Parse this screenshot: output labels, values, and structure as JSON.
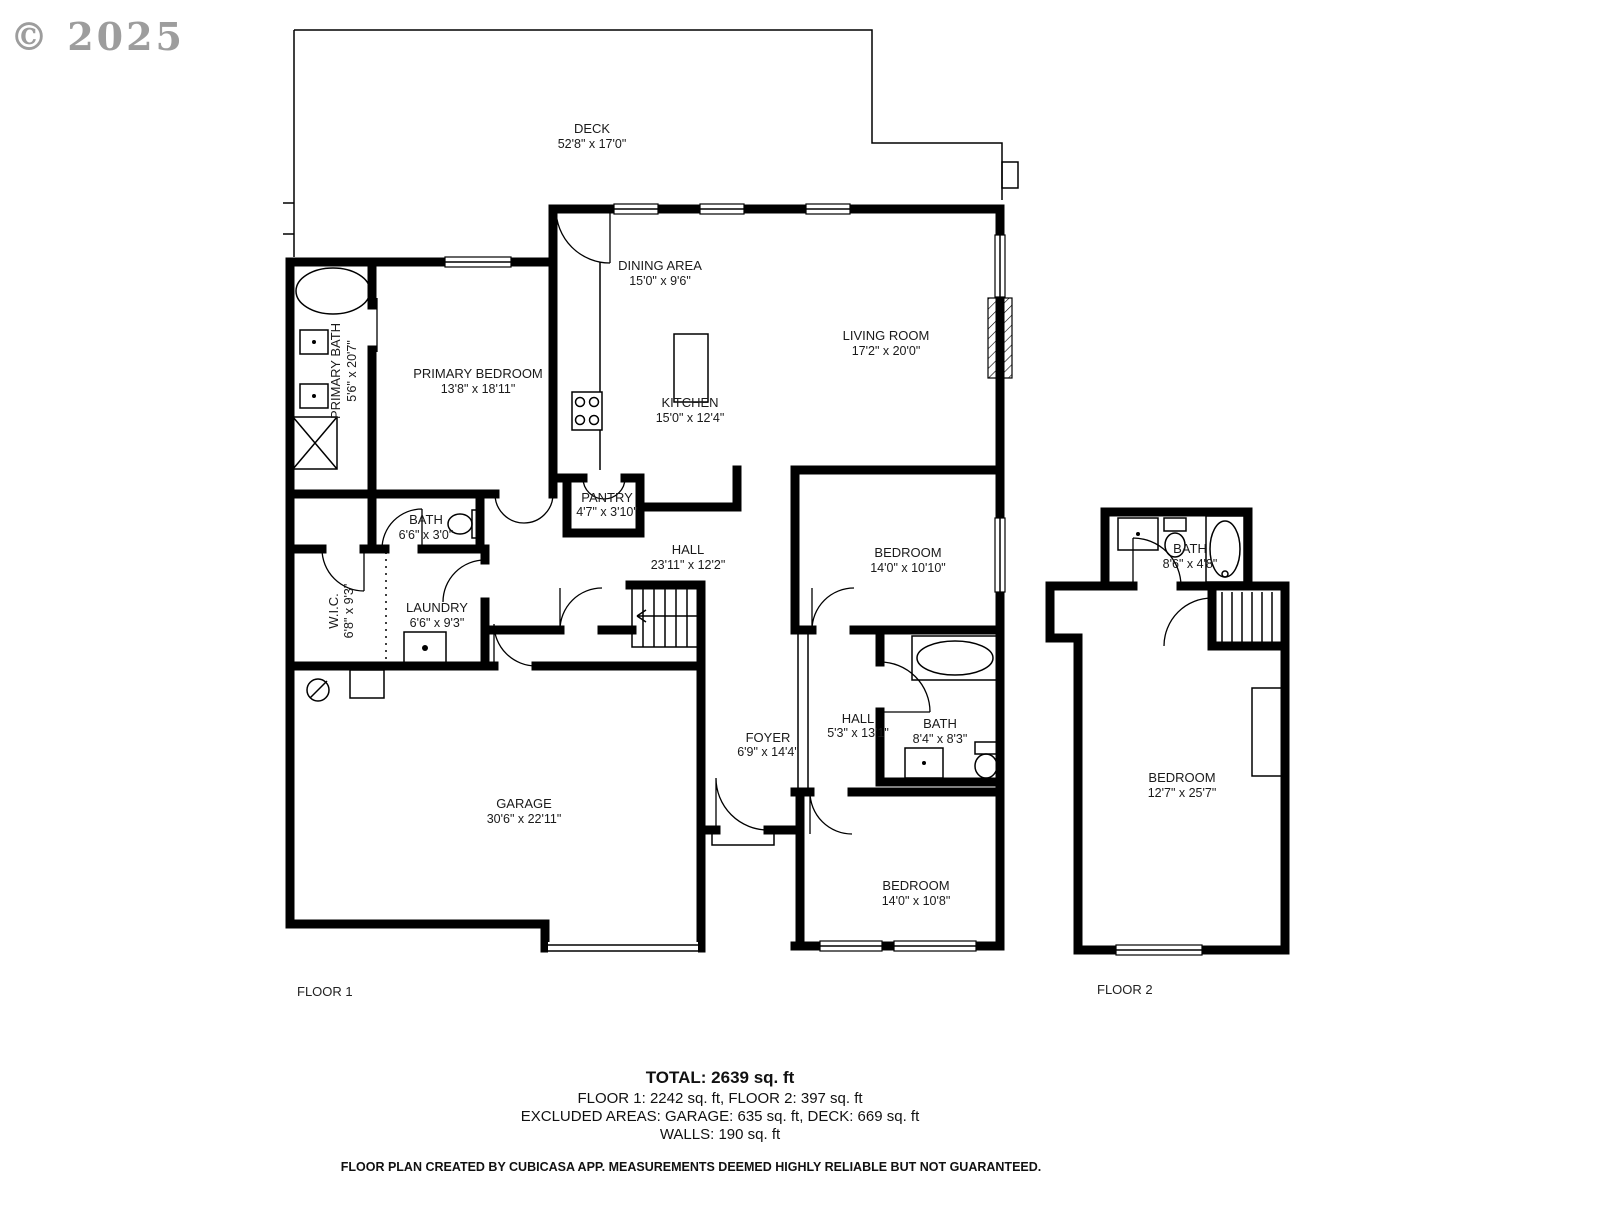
{
  "watermark": "© 2025",
  "floor1": {
    "label": "FLOOR 1",
    "rooms": {
      "deck": {
        "name": "DECK",
        "dims": "52'8\" x 17'0\""
      },
      "dining": {
        "name": "DINING AREA",
        "dims": "15'0\" x 9'6\""
      },
      "living": {
        "name": "LIVING ROOM",
        "dims": "17'2\" x 20'0\""
      },
      "primary_bedroom": {
        "name": "PRIMARY BEDROOM",
        "dims": "13'8\" x 18'11\""
      },
      "primary_bath": {
        "name": "PRIMARY BATH",
        "dims": "5'6\" x 20'7\""
      },
      "kitchen": {
        "name": "KITCHEN",
        "dims": "15'0\" x 12'4\""
      },
      "pantry": {
        "name": "PANTRY",
        "dims": "4'7\" x 3'10\""
      },
      "hall": {
        "name": "HALL",
        "dims": "23'11\" x 12'2\""
      },
      "bath": {
        "name": "BATH",
        "dims": "6'6\" x 3'0\""
      },
      "wic": {
        "name": "W.I.C.",
        "dims": "6'8\" x 9'3\""
      },
      "laundry": {
        "name": "LAUNDRY",
        "dims": "6'6\" x 9'3\""
      },
      "bedroom1": {
        "name": "BEDROOM",
        "dims": "14'0\" x 10'10\""
      },
      "hall2": {
        "name": "HALL",
        "dims": "5'3\" x 13'1\""
      },
      "bath2": {
        "name": "BATH",
        "dims": "8'4\" x 8'3\""
      },
      "foyer": {
        "name": "FOYER",
        "dims": "6'9\" x 14'4\""
      },
      "garage": {
        "name": "GARAGE",
        "dims": "30'6\" x 22'11\""
      },
      "bedroom2": {
        "name": "BEDROOM",
        "dims": "14'0\" x 10'8\""
      }
    }
  },
  "floor2": {
    "label": "FLOOR 2",
    "rooms": {
      "bath": {
        "name": "BATH",
        "dims": "8'6\" x 4'8\""
      },
      "bedroom": {
        "name": "BEDROOM",
        "dims": "12'7\" x 25'7\""
      }
    }
  },
  "summary": {
    "total": "TOTAL: 2639 sq. ft",
    "floors": "FLOOR 1: 2242 sq. ft, FLOOR 2: 397 sq. ft",
    "excluded": "EXCLUDED AREAS: GARAGE: 635 sq. ft, DECK: 669 sq. ft",
    "walls": "WALLS: 190 sq. ft"
  },
  "disclaimer": "FLOOR PLAN CREATED BY CUBICASA APP. MEASUREMENTS DEEMED HIGHLY RELIABLE BUT NOT GUARANTEED.",
  "colors": {
    "wall": "#000000",
    "background": "#ffffff",
    "label": "#1a1a1a",
    "watermark": "#8c8c8c"
  }
}
